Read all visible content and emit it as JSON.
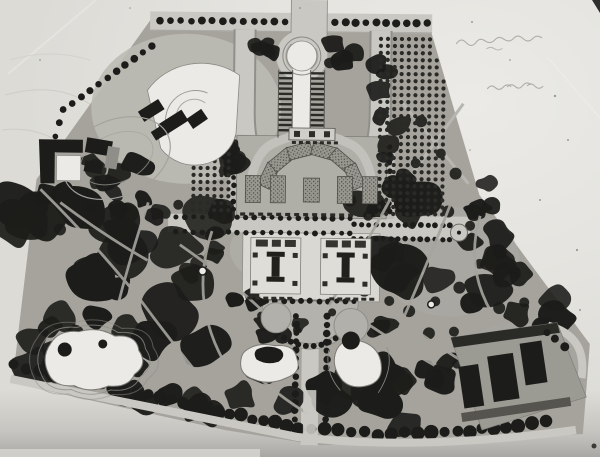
{
  "photo": {
    "description": "Black-and-white photograph of a formal landscape master plan drawing",
    "annotations": [
      {
        "name": "handwritten-note-1",
        "text": "(illegible handwritten pencil note)"
      },
      {
        "name": "handwritten-note-2",
        "text": "(illegible handwritten pencil note)"
      }
    ]
  },
  "colors": {
    "mount": "#b5b4b0",
    "paper": "#dcdbd6",
    "paper_bright": "#ebeae6",
    "ground": "#a5a39c",
    "ground_light": "#bcbbb4",
    "road": "#c9c8c2",
    "road_edge": "#8a8983",
    "ink": "#1c1c1a",
    "ink_soft": "#2a2a26",
    "white_feature": "#eceae6",
    "terrace": "#d9d8d2",
    "water_outline": "#7c7b75",
    "bed_base": "#999890",
    "pencil": "#a5a49e"
  },
  "features": [
    {
      "name": "site-plan-drawing",
      "label": "Photograph of a formal park master plan"
    },
    {
      "name": "north-entry-avenue",
      "label": "Axial entry avenue at top"
    },
    {
      "name": "horseshoe-drive",
      "label": "Horseshoe drive around head of mall"
    },
    {
      "name": "head-pool",
      "label": "Keyhole-shaped head pool"
    },
    {
      "name": "central-mall",
      "label": "Central mall with twin colonnade walks"
    },
    {
      "name": "parterre-terrace",
      "label": "Arched parterre garden terrace"
    },
    {
      "name": "cross-road",
      "label": "Tree-lined cross road"
    },
    {
      "name": "grand-terrace",
      "label": "Grand terrace with twin pavilions"
    },
    {
      "name": "semicircular-plaza",
      "label": "Semicircular tree-ringed plaza"
    },
    {
      "name": "south-avenue",
      "label": "Tree-lined south avenue"
    },
    {
      "name": "tree-grid-bosque-west",
      "label": "Gridded bosque planting, west"
    },
    {
      "name": "tree-grid-bosque-east",
      "label": "Gridded bosque planting, east"
    },
    {
      "name": "amphitheater",
      "label": "Fan-shaped amphitheater ground"
    },
    {
      "name": "athletic-oval",
      "label": "Athletic oval"
    },
    {
      "name": "west-buildings",
      "label": "Courtyard building group, west edge"
    },
    {
      "name": "east-allee",
      "label": "Eastern allee with rond-point"
    },
    {
      "name": "west-lake",
      "label": "Naturalistic lake, southwest"
    },
    {
      "name": "twin-ponds",
      "label": "Twin ponds flanking south avenue"
    },
    {
      "name": "southeast-building-complex",
      "label": "Building complex, southeast corner"
    },
    {
      "name": "woodland",
      "label": "Dense woodland planting"
    },
    {
      "name": "boundary-tree-row",
      "label": "Boundary street tree row"
    },
    {
      "name": "photo-paper",
      "label": "Photographic paper margin"
    }
  ]
}
